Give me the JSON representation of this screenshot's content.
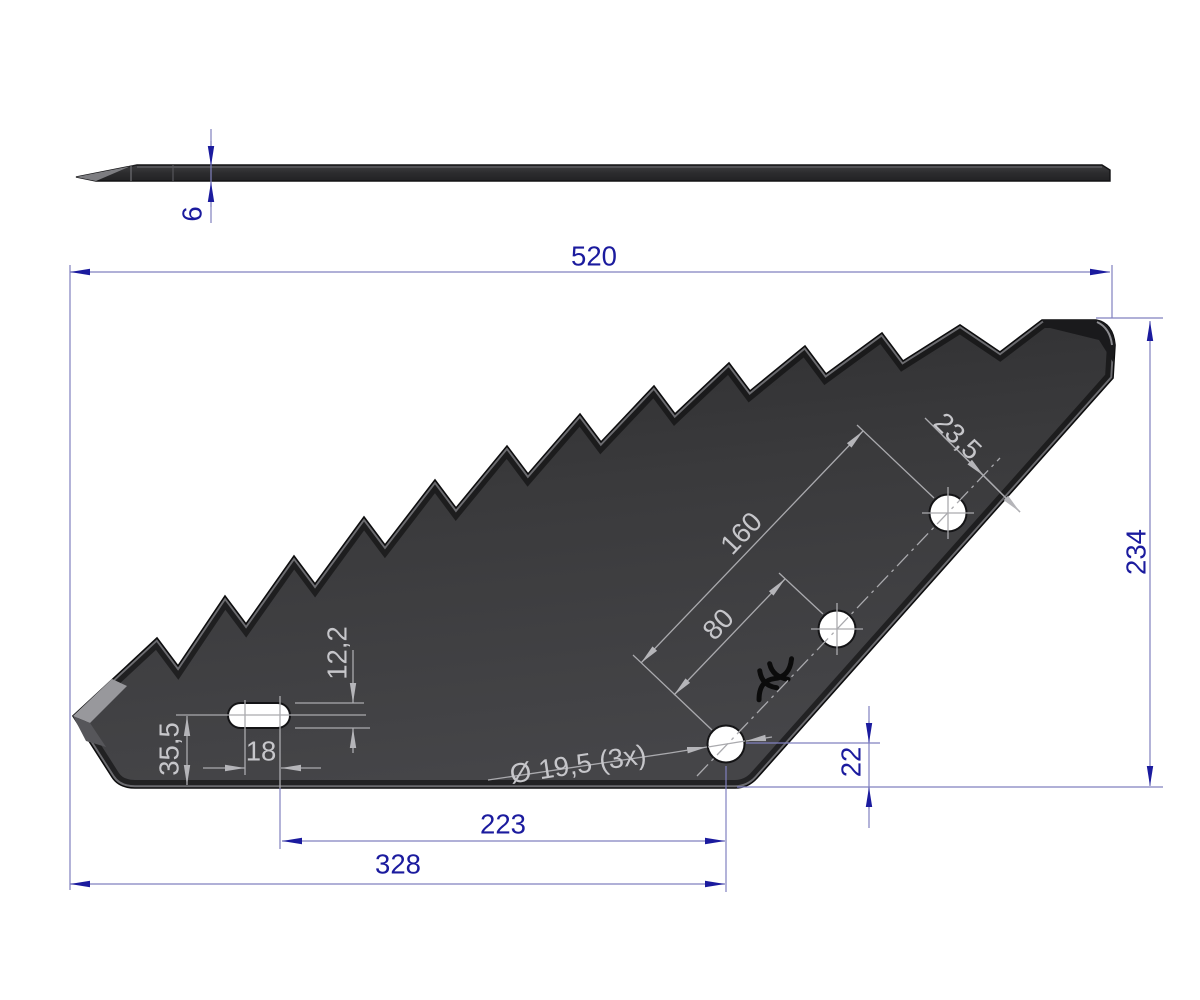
{
  "colors": {
    "dim_primary": "#1b1b9e",
    "dim_on_blade": "#c6c6ca",
    "blade_body": "#3a3a3c",
    "blade_bevel": "#6b6b6f",
    "background": "#ffffff"
  },
  "dims": {
    "thickness": "6",
    "overall_width": "520",
    "overall_height": "234",
    "edge_to_hole_line": "23,5",
    "hole_span": "160",
    "hole_pitch": "80",
    "slot_width": "12,2",
    "slot_center_to_bottom": "35,5",
    "slot_pitch": "18",
    "hole_diameter": "Ø 19,5 (3x)",
    "hole_to_bottom": "22",
    "slot_to_hole": "223",
    "left_edge_to_hole": "328"
  }
}
